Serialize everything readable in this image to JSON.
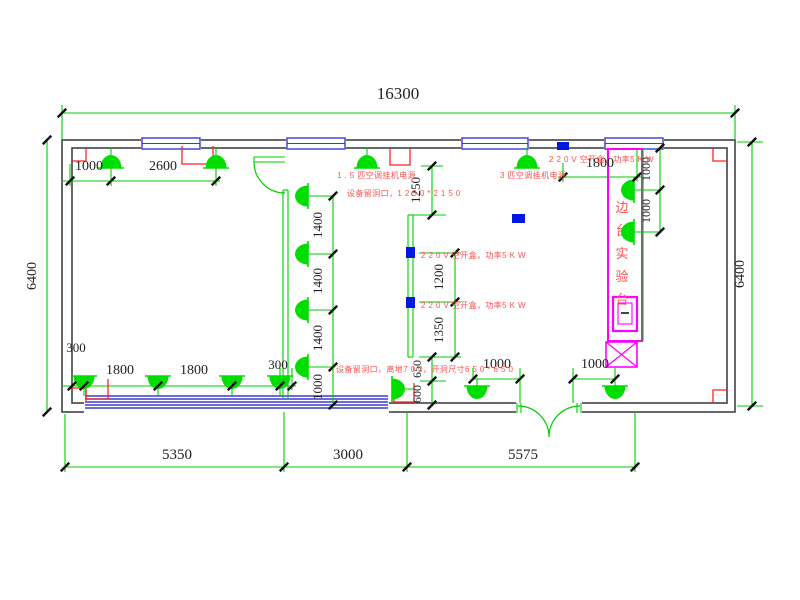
{
  "drawing": {
    "type": "electrical-floor-plan",
    "canvas": {
      "w": 800,
      "h": 600
    },
    "colors": {
      "wall": "#4d4d4d",
      "green": "#00cc00",
      "lamp": "#00dd00",
      "window_blue": "#3b3bd1",
      "socket_blue": "#0018e0",
      "annotation_red": "#ff5050",
      "mark_red": "#ff2222",
      "bench_magenta": "#ff00ff",
      "dim_text": "#222222",
      "tick": "#111111"
    },
    "wall": {
      "outer": [
        62,
        140,
        735,
        412
      ],
      "inner": [
        72,
        148,
        727,
        403
      ]
    },
    "openings": [
      [
        84,
        393,
        305,
        21
      ],
      [
        516,
        393,
        66,
        21
      ]
    ],
    "top_windows": [
      [
        142,
        138,
        58,
        11
      ],
      [
        287,
        138,
        58,
        11
      ],
      [
        462,
        138,
        66,
        11
      ],
      [
        605,
        138,
        58,
        11
      ]
    ],
    "bottom_band": {
      "x1": 85,
      "x2": 388,
      "ys": [
        396,
        399,
        402,
        405,
        408
      ]
    },
    "bench": {
      "outer": [
        608,
        149,
        34,
        192
      ],
      "edge_line": [
        643,
        148,
        643,
        341
      ],
      "top_line": [
        605,
        149,
        643,
        149
      ],
      "sink_outer": [
        613,
        297,
        24,
        34
      ],
      "sink_inner": [
        618,
        303,
        14,
        21
      ],
      "sink_glyph": [
        621,
        313,
        629,
        313
      ],
      "cross_box": [
        606,
        342,
        31,
        25
      ],
      "label": {
        "text": "边台实验台",
        "x": 622,
        "y_start": 212,
        "dy": 23,
        "size": 13
      }
    },
    "green_lines": [
      [
        62,
        105,
        62,
        140
      ],
      [
        735,
        105,
        735,
        140
      ],
      [
        62,
        113,
        735,
        113
      ],
      [
        47,
        140,
        47,
        412
      ],
      [
        752,
        142,
        752,
        406
      ],
      [
        737,
        142,
        763,
        142
      ],
      [
        737,
        406,
        763,
        406
      ],
      [
        111,
        148,
        111,
        186
      ],
      [
        216,
        148,
        216,
        186
      ],
      [
        70,
        164,
        70,
        186
      ],
      [
        62,
        181,
        220,
        181
      ],
      [
        367,
        148,
        367,
        160
      ],
      [
        527,
        148,
        527,
        160
      ],
      [
        563,
        163,
        563,
        182
      ],
      [
        637,
        150,
        637,
        182
      ],
      [
        558,
        177,
        642,
        177
      ],
      [
        660,
        148,
        660,
        232
      ],
      [
        634,
        190,
        662,
        190
      ],
      [
        634,
        232,
        662,
        232
      ],
      [
        432,
        166,
        432,
        215
      ],
      [
        421,
        166,
        443,
        166
      ],
      [
        410,
        215,
        446,
        215
      ],
      [
        455,
        253,
        455,
        357
      ],
      [
        419,
        253,
        461,
        253
      ],
      [
        419,
        302,
        461,
        302
      ],
      [
        419,
        357,
        461,
        357
      ],
      [
        432,
        357,
        432,
        405
      ],
      [
        420,
        381,
        446,
        381
      ],
      [
        333,
        196,
        333,
        405
      ],
      [
        308,
        196,
        333,
        196
      ],
      [
        308,
        254,
        333,
        254
      ],
      [
        308,
        310,
        333,
        310
      ],
      [
        308,
        367,
        333,
        367
      ],
      [
        62,
        386,
        296,
        386
      ],
      [
        292,
        368,
        292,
        390
      ],
      [
        280,
        368,
        280,
        390
      ],
      [
        84,
        376,
        84,
        396
      ],
      [
        158,
        376,
        158,
        396
      ],
      [
        232,
        376,
        232,
        396
      ],
      [
        280,
        376,
        280,
        396
      ],
      [
        473,
        379,
        520,
        379
      ],
      [
        573,
        379,
        615,
        379
      ],
      [
        477,
        379,
        477,
        386
      ],
      [
        615,
        379,
        615,
        386
      ],
      [
        520,
        368,
        520,
        403
      ],
      [
        573,
        368,
        573,
        403
      ],
      [
        473,
        368,
        473,
        379
      ],
      [
        615,
        368,
        615,
        379
      ],
      [
        392,
        389,
        414,
        389
      ],
      [
        65,
        414,
        65,
        472
      ],
      [
        284,
        412,
        284,
        472
      ],
      [
        407,
        412,
        407,
        472
      ],
      [
        635,
        412,
        635,
        472
      ],
      [
        65,
        467,
        635,
        467
      ],
      [
        283,
        190,
        283,
        398
      ],
      [
        288,
        190,
        288,
        398
      ],
      [
        283,
        190,
        288,
        190
      ],
      [
        408,
        215,
        408,
        357
      ],
      [
        413,
        215,
        413,
        357
      ],
      [
        408,
        215,
        413,
        215
      ],
      [
        408,
        357,
        413,
        357
      ],
      [
        254,
        157,
        285,
        157
      ],
      [
        254,
        162,
        285,
        162
      ],
      [
        254,
        157,
        254,
        162
      ],
      [
        517,
        403,
        517,
        413
      ],
      [
        521,
        403,
        521,
        413
      ],
      [
        577,
        403,
        577,
        413
      ],
      [
        581,
        403,
        581,
        413
      ]
    ],
    "door_arcs": [
      "M254,162 A31,31 0 0 0 285,193",
      "M518,406 A31,31 0 0 1 549,437",
      "M580,406 A31,31 0 0 0 549,437"
    ],
    "red_marks": [
      [
        [
          72,
          161
        ],
        [
          86,
          161
        ],
        [
          86,
          148
        ]
      ],
      [
        [
          72,
          388
        ],
        [
          86,
          388
        ],
        [
          86,
          402
        ]
      ],
      [
        [
          727,
          161
        ],
        [
          713,
          161
        ],
        [
          713,
          148
        ]
      ],
      [
        [
          727,
          390
        ],
        [
          713,
          390
        ],
        [
          713,
          403
        ]
      ],
      [
        [
          182,
          146
        ],
        [
          182,
          164
        ],
        [
          213,
          164
        ],
        [
          213,
          146
        ]
      ],
      [
        [
          390,
          147
        ],
        [
          390,
          165
        ],
        [
          410,
          165
        ],
        [
          410,
          147
        ]
      ],
      [
        [
          86,
          379
        ],
        [
          86,
          399
        ],
        [
          108,
          399
        ],
        [
          108,
          379
        ]
      ],
      [
        [
          394,
          383
        ],
        [
          394,
          402
        ],
        [
          414,
          402
        ],
        [
          414,
          383
        ]
      ]
    ],
    "lamps": [
      {
        "x": 111,
        "y": 168,
        "dir": "u"
      },
      {
        "x": 216,
        "y": 168,
        "dir": "u"
      },
      {
        "x": 367,
        "y": 168,
        "dir": "u"
      },
      {
        "x": 527,
        "y": 168,
        "dir": "u"
      },
      {
        "x": 634,
        "y": 190,
        "dir": "l"
      },
      {
        "x": 634,
        "y": 232,
        "dir": "l"
      },
      {
        "x": 308,
        "y": 196,
        "dir": "l"
      },
      {
        "x": 308,
        "y": 254,
        "dir": "l"
      },
      {
        "x": 308,
        "y": 310,
        "dir": "l"
      },
      {
        "x": 308,
        "y": 367,
        "dir": "l"
      },
      {
        "x": 84,
        "y": 376,
        "dir": "d"
      },
      {
        "x": 158,
        "y": 376,
        "dir": "d"
      },
      {
        "x": 232,
        "y": 376,
        "dir": "d"
      },
      {
        "x": 280,
        "y": 376,
        "dir": "d"
      },
      {
        "x": 477,
        "y": 386,
        "dir": "d"
      },
      {
        "x": 615,
        "y": 386,
        "dir": "d"
      },
      {
        "x": 392,
        "y": 389,
        "dir": "r"
      }
    ],
    "sockets": [
      [
        512,
        214,
        13,
        9
      ],
      [
        557,
        142,
        12,
        8
      ],
      [
        406,
        247,
        9,
        11
      ],
      [
        406,
        297,
        9,
        11
      ]
    ],
    "ticks": [
      [
        62,
        113
      ],
      [
        735,
        113
      ],
      [
        47,
        140
      ],
      [
        47,
        412
      ],
      [
        752,
        142
      ],
      [
        752,
        406
      ],
      [
        70,
        181
      ],
      [
        111,
        181
      ],
      [
        216,
        181
      ],
      [
        563,
        177
      ],
      [
        637,
        177
      ],
      [
        660,
        148
      ],
      [
        660,
        190
      ],
      [
        660,
        232
      ],
      [
        432,
        166
      ],
      [
        432,
        215
      ],
      [
        455,
        253
      ],
      [
        455,
        302
      ],
      [
        455,
        357
      ],
      [
        432,
        357
      ],
      [
        432,
        381
      ],
      [
        432,
        405
      ],
      [
        333,
        196
      ],
      [
        333,
        254
      ],
      [
        333,
        310
      ],
      [
        333,
        367
      ],
      [
        333,
        405
      ],
      [
        72,
        386
      ],
      [
        84,
        386
      ],
      [
        158,
        386
      ],
      [
        232,
        386
      ],
      [
        280,
        386
      ],
      [
        292,
        386
      ],
      [
        473,
        379
      ],
      [
        520,
        379
      ],
      [
        573,
        379
      ],
      [
        615,
        379
      ],
      [
        65,
        467
      ],
      [
        284,
        467
      ],
      [
        407,
        467
      ],
      [
        635,
        467
      ]
    ],
    "dim_texts": [
      {
        "t": "16300",
        "x": 398,
        "y": 99,
        "s": 17,
        "r": 0
      },
      {
        "t": "6400",
        "x": 36,
        "y": 276,
        "s": 14,
        "r": -90
      },
      {
        "t": "6400",
        "x": 744,
        "y": 274,
        "s": 14,
        "r": -90
      },
      {
        "t": "1000",
        "x": 89,
        "y": 170,
        "s": 14,
        "r": 0
      },
      {
        "t": "2600",
        "x": 163,
        "y": 170,
        "s": 14,
        "r": 0
      },
      {
        "t": "1800",
        "x": 600,
        "y": 167,
        "s": 14,
        "r": 0
      },
      {
        "t": "1000",
        "x": 650,
        "y": 169,
        "s": 12,
        "r": -90
      },
      {
        "t": "1000",
        "x": 650,
        "y": 211,
        "s": 12,
        "r": -90
      },
      {
        "t": "1250",
        "x": 420,
        "y": 190,
        "s": 13,
        "r": -90
      },
      {
        "t": "1200",
        "x": 443,
        "y": 277,
        "s": 13,
        "r": -90
      },
      {
        "t": "1350",
        "x": 443,
        "y": 330,
        "s": 13,
        "r": -90
      },
      {
        "t": "650",
        "x": 421,
        "y": 369,
        "s": 12,
        "r": -90
      },
      {
        "t": "600",
        "x": 421,
        "y": 394,
        "s": 12,
        "r": -90
      },
      {
        "t": "1400",
        "x": 322,
        "y": 225,
        "s": 13,
        "r": -90
      },
      {
        "t": "1400",
        "x": 322,
        "y": 281,
        "s": 13,
        "r": -90
      },
      {
        "t": "1400",
        "x": 322,
        "y": 338,
        "s": 13,
        "r": -90
      },
      {
        "t": "1000",
        "x": 322,
        "y": 387,
        "s": 13,
        "r": -90
      },
      {
        "t": "300",
        "x": 76,
        "y": 352,
        "s": 13,
        "r": 0
      },
      {
        "t": "1800",
        "x": 120,
        "y": 374,
        "s": 14,
        "r": 0
      },
      {
        "t": "1800",
        "x": 194,
        "y": 374,
        "s": 14,
        "r": 0
      },
      {
        "t": "300",
        "x": 278,
        "y": 369,
        "s": 13,
        "r": 0
      },
      {
        "t": "1000",
        "x": 497,
        "y": 368,
        "s": 14,
        "r": 0
      },
      {
        "t": "1000",
        "x": 595,
        "y": 368,
        "s": 14,
        "r": 0
      },
      {
        "t": "5350",
        "x": 177,
        "y": 459,
        "s": 15,
        "r": 0
      },
      {
        "t": "3000",
        "x": 348,
        "y": 459,
        "s": 15,
        "r": 0
      },
      {
        "t": "5575",
        "x": 523,
        "y": 459,
        "s": 15,
        "r": 0
      }
    ],
    "annotations": [
      {
        "t": "1 . 5 匹空调挂机电源",
        "x": 337,
        "y": 178
      },
      {
        "t": "3 匹空调挂机电源",
        "x": 500,
        "y": 178
      },
      {
        "t": "设备留洞口，1 2 5 0 * 2 1 5 0",
        "x": 347,
        "y": 196
      },
      {
        "t": "2 2 0 V 空开盒，功率5 K W",
        "x": 549,
        "y": 162
      },
      {
        "t": "2 2 0 V 空开盒，功率5 K W",
        "x": 421,
        "y": 258
      },
      {
        "t": "2 2 0 V 空开盒，功率5 K W",
        "x": 421,
        "y": 308
      },
      {
        "t": "设备留洞口，离地7 0 0，开洞尺寸6 5 0 * 6 5 0",
        "x": 336,
        "y": 372
      }
    ]
  }
}
